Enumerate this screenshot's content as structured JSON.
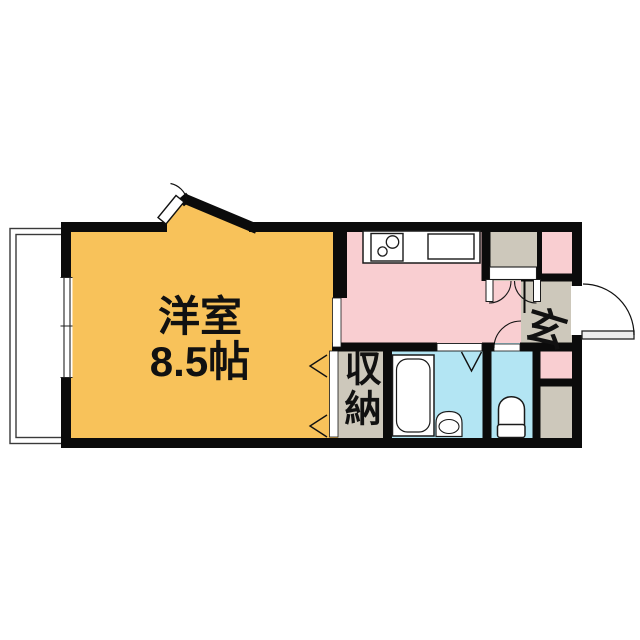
{
  "plan": {
    "type": "apartment-floor-plan",
    "rooms": {
      "western": {
        "label": "洋室",
        "size": "8.5帖",
        "color": "#f8c25a"
      },
      "kitchen_hall": {
        "color": "#f9ced1"
      },
      "entrance": {
        "label": "玄",
        "color": "#cdc8bb"
      },
      "storage": {
        "label": "収納",
        "color": "#cdc8bb"
      },
      "upper_closet": {
        "color": "#cdc8bb"
      },
      "utility_corner": {
        "color": "#cdc8bb"
      },
      "bathroom": {
        "color": "#b3e5f3"
      },
      "toilet": {
        "color": "#b3e5f3"
      },
      "nook_upper_right": {
        "color": "#f9ced1"
      },
      "nook_lower_right": {
        "color": "#f9ced1"
      },
      "balcony": {
        "color": "#ffffff"
      }
    },
    "colors": {
      "wall": "#0b0b0b",
      "fixture_outline": "#1a1a1a",
      "balcony_line": "#3a3a3a",
      "background": "#ffffff"
    },
    "icons": {
      "stove": "stove-icon",
      "sink": "sink-icon",
      "bathtub": "bathtub-icon",
      "wash_basin": "basin-icon",
      "toilet": "toilet-icon",
      "door_swing": "door-arc-icon",
      "folding_door": "folding-door-icon",
      "window": "sliding-window-icon"
    }
  }
}
